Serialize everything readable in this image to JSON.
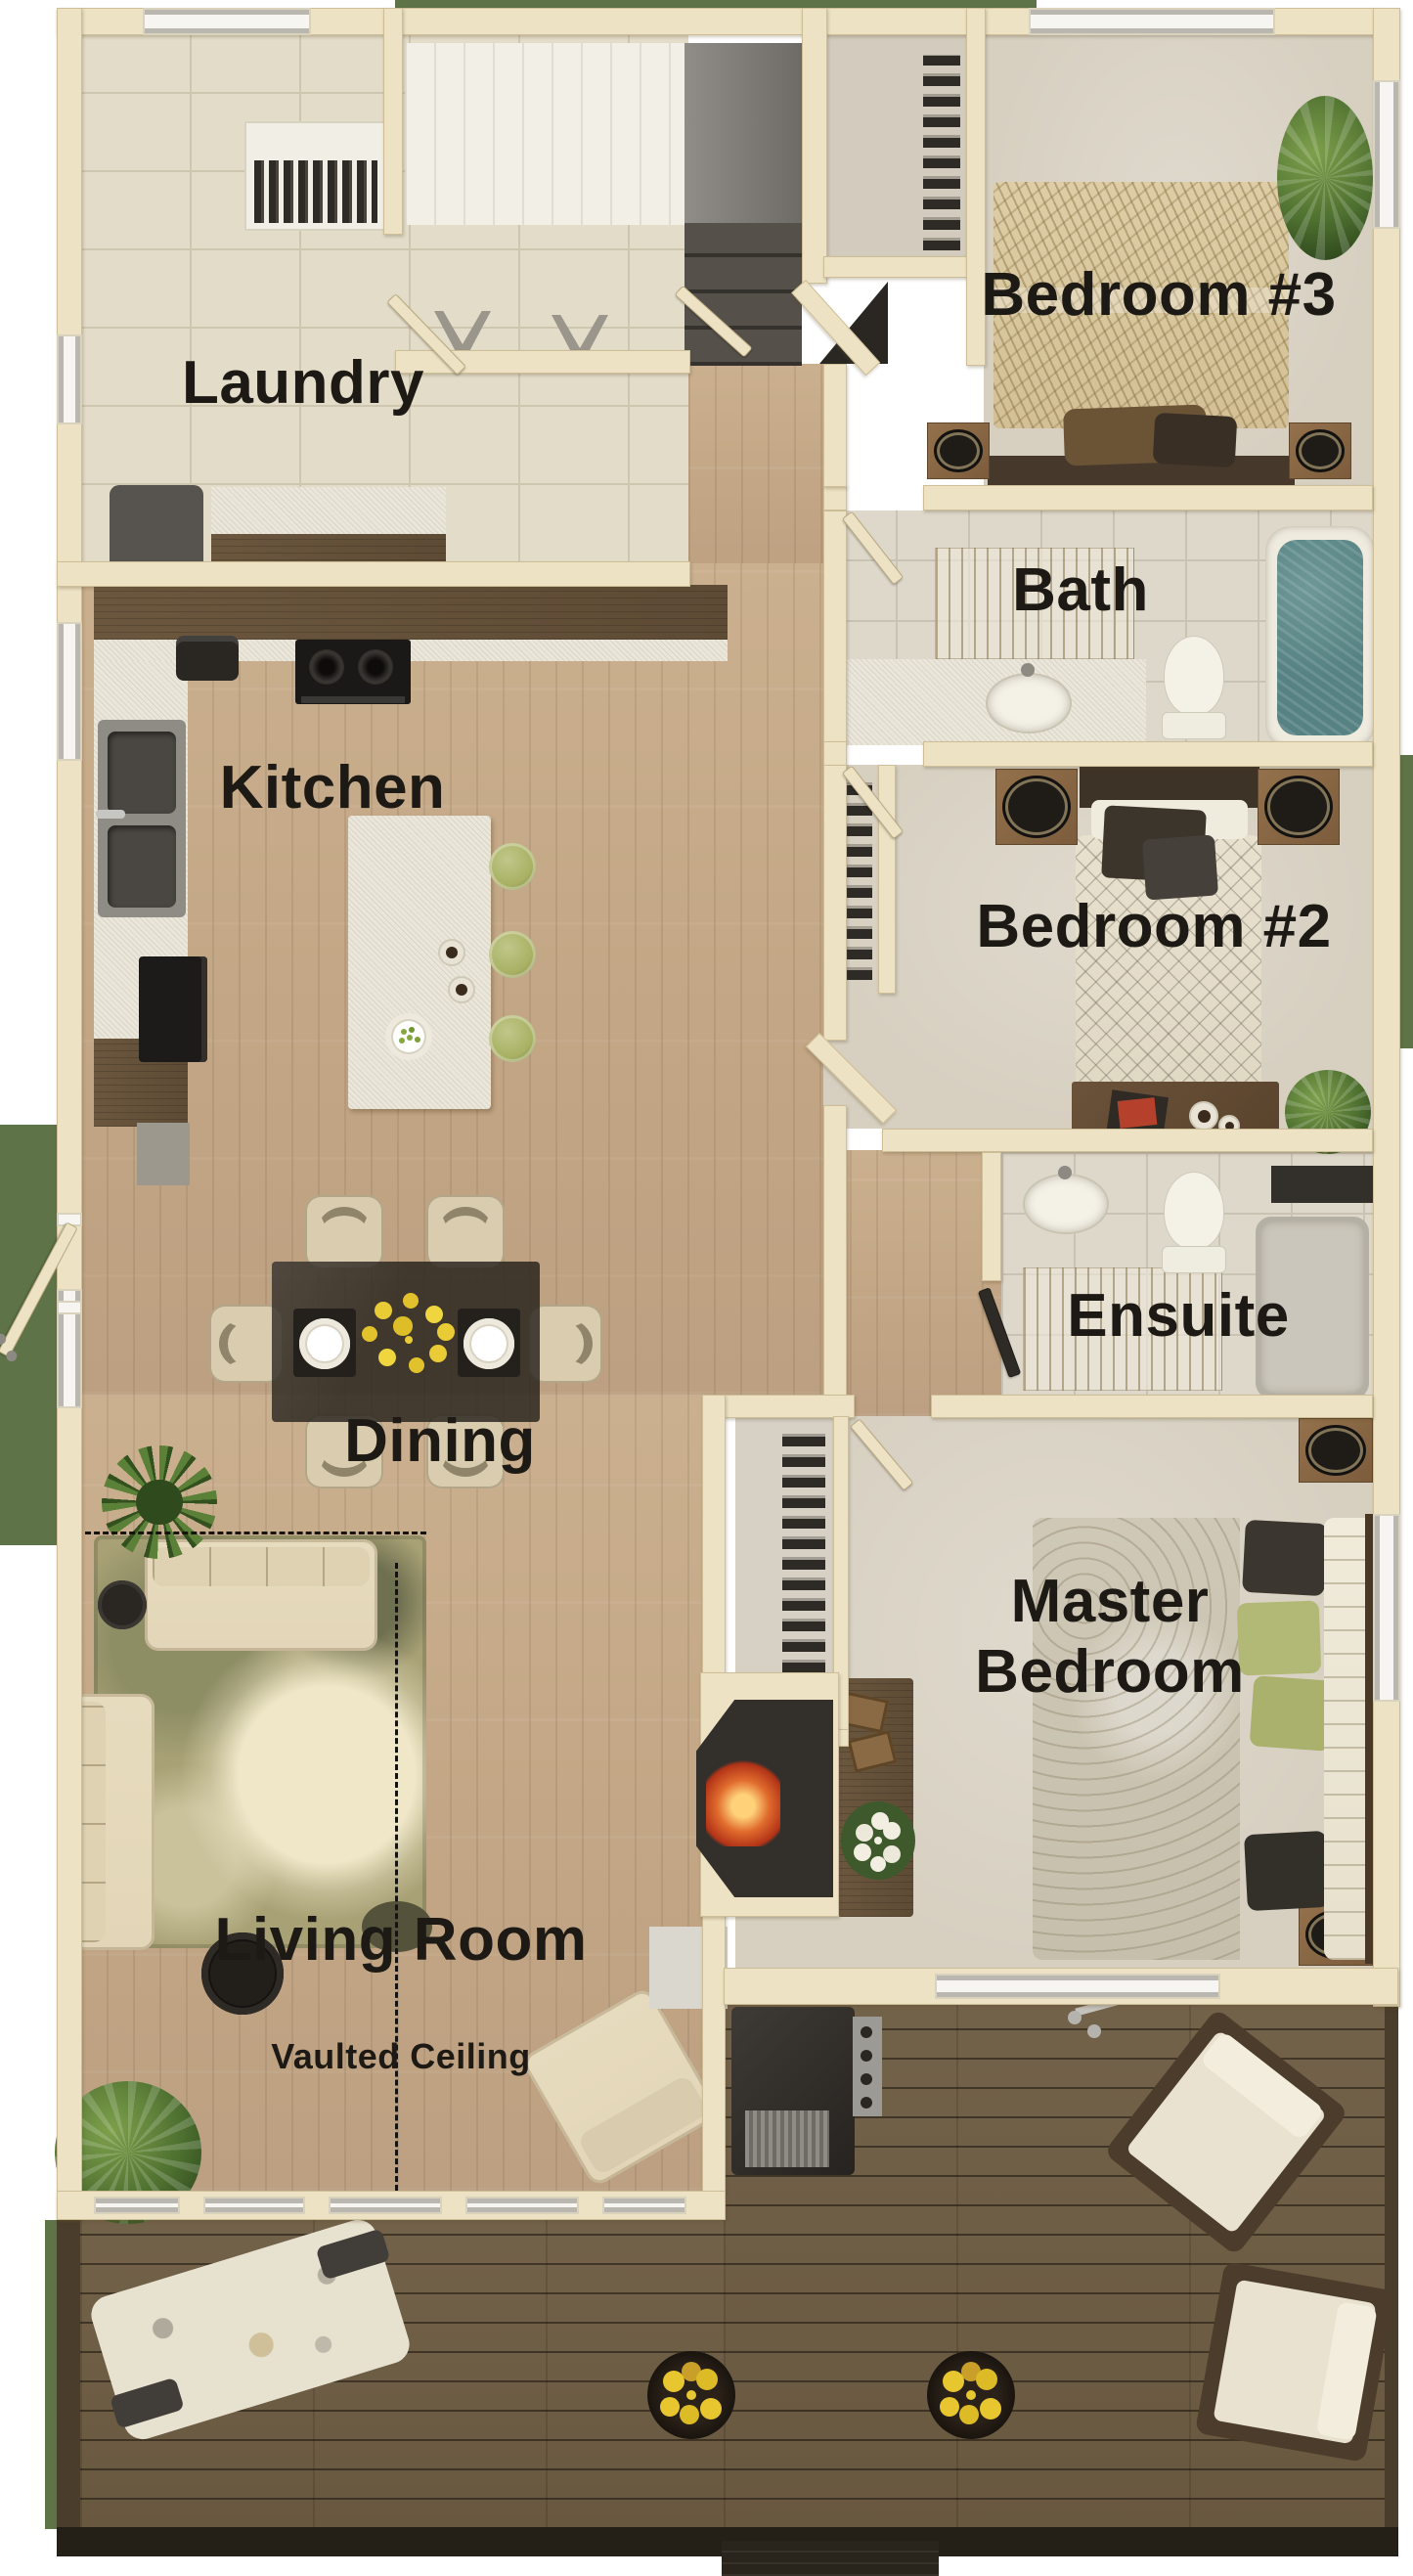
{
  "labels": {
    "laundry": "Laundry",
    "kitchen": "Kitchen",
    "dining": "Dining",
    "living": "Living Room",
    "vaulted": "Vaulted Ceiling",
    "bedroom3": "Bedroom #3",
    "bath": "Bath",
    "bedroom2": "Bedroom #2",
    "ensuite": "Ensuite",
    "master": "Master\nBedroom"
  },
  "colors": {
    "wall": "#EDE2C4",
    "ink": "#1D1A15",
    "wood": "#C2A685",
    "deck": "#695840",
    "tile": "#E3DCC8",
    "tile2": "#DED8CB",
    "carpet": "#D7D0C1",
    "grass": "#5E7347",
    "water": "#578283",
    "fire": "#E06B2D",
    "green": "#A9B164",
    "yellow": "#E8C832",
    "rug": "#A8A175",
    "cream": "#E3D6B8",
    "darkwood": "#5E4B35"
  }
}
